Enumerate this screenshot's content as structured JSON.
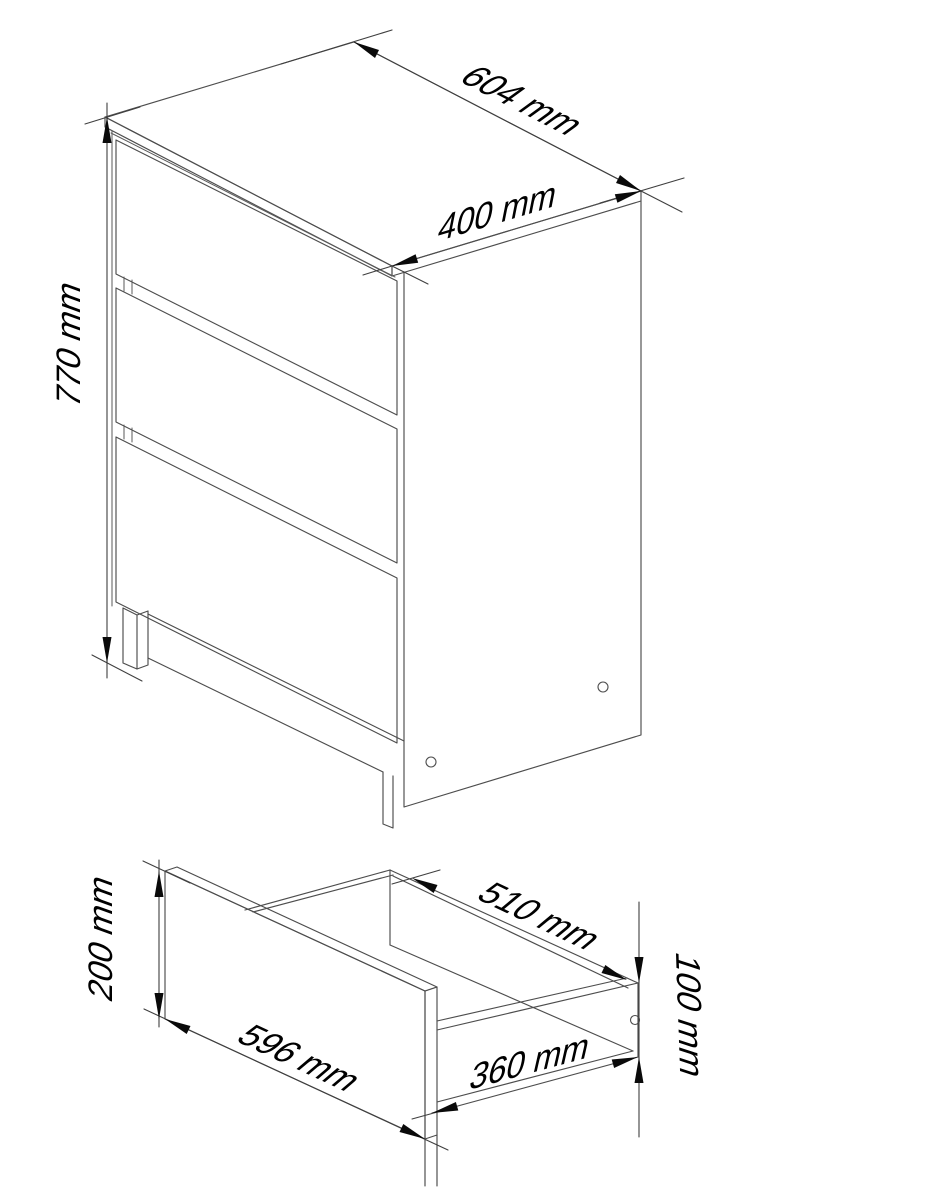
{
  "page": {
    "kind": "furniture assembly technical drawing",
    "background": "#ffffff"
  },
  "colors": {
    "line": "#4d4d4d",
    "dimension_line": "#3f3f3f",
    "text": "#000000"
  },
  "views": {
    "chest": {
      "name": "three-drawer chest isometric view",
      "dimensions": {
        "width": "604 mm",
        "depth": "400 mm",
        "height": "770 mm"
      }
    },
    "drawer": {
      "name": "single drawer isometric view",
      "dimensions": {
        "front_width": "596 mm",
        "front_height": "200 mm",
        "inner_width": "510 mm",
        "side_depth": "360 mm",
        "side_height": "100 mm"
      }
    }
  }
}
